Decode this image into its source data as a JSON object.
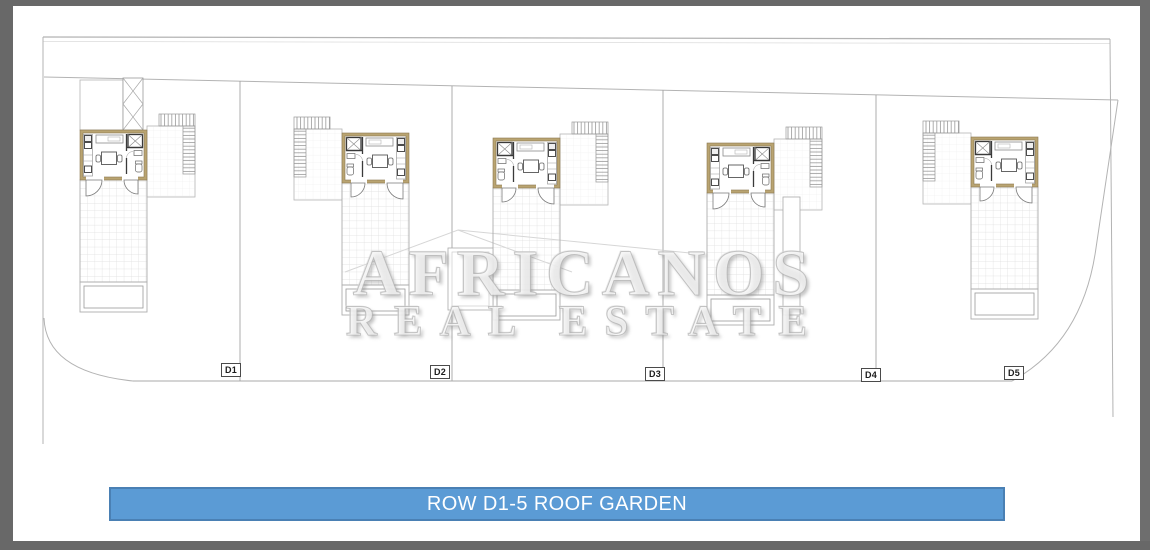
{
  "page": {
    "type": "architectural-roof-plan-sheet",
    "banner": {
      "label": "ROW D1-5 ROOF GARDEN"
    },
    "watermark": {
      "line1": "AFRICANOS",
      "line2": "REAL ESTATE"
    },
    "units": [
      {
        "label": "D1"
      },
      {
        "label": "D2"
      },
      {
        "label": "D3"
      },
      {
        "label": "D4"
      },
      {
        "label": "D5"
      }
    ],
    "colors": {
      "banner_fill": "#5b9bd5",
      "banner_border": "#4a80b4",
      "banner_text": "#ffffff",
      "wall_accent": "#b9a471",
      "plan_line_gray": "#b3b3b3",
      "frame_gray": "#686868"
    }
  }
}
